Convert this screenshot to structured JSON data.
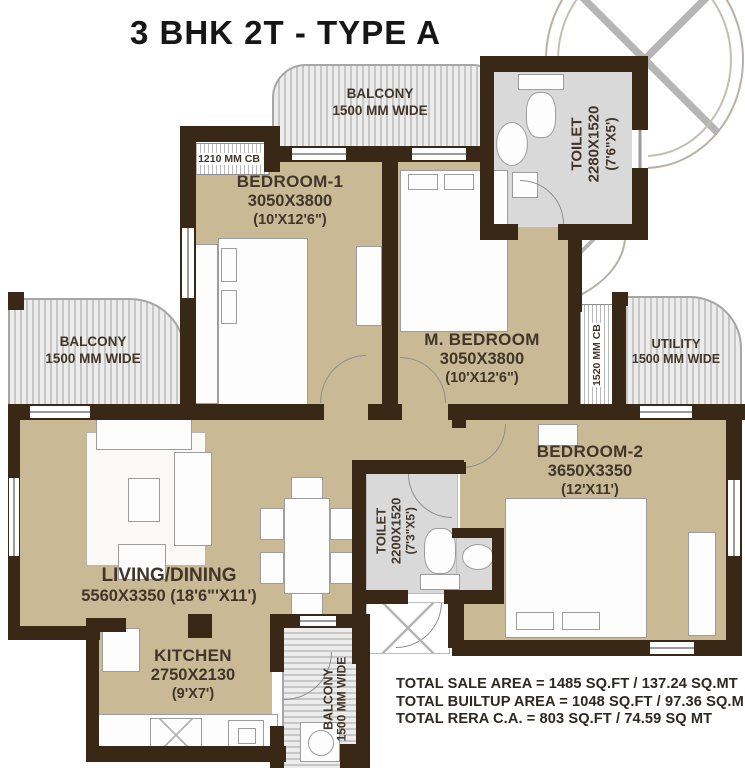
{
  "title": "3 BHK 2T - TYPE A",
  "colors": {
    "wall": "#3a2817",
    "floor": "#c9ba95",
    "balcony_fill": "#e0e0e0",
    "toilet_fill": "#d9d9d9",
    "label_text": "#42352a"
  },
  "rooms": {
    "bedroom1": {
      "name": "BEDROOM-1",
      "dim_mm": "3050X3800",
      "dim_ft": "(10'X12'6\")"
    },
    "m_bedroom": {
      "name": "M. BEDROOM",
      "dim_mm": "3050X3800",
      "dim_ft": "(10'X12'6\")"
    },
    "bedroom2": {
      "name": "BEDROOM-2",
      "dim_mm": "3650X3350",
      "dim_ft": "(12'X11')"
    },
    "living_dining": {
      "name": "LIVING/DINING",
      "dims": "5560X3350 (18'6\"'X11')"
    },
    "kitchen": {
      "name": "KITCHEN",
      "dim_mm": "2750X2130",
      "dim_ft": "(9'X7')"
    },
    "toilet_top": {
      "name": "TOILET",
      "dim_mm": "2280X1520",
      "dim_ft": "(7'6\"X5')"
    },
    "toilet_mid": {
      "name": "TOILET",
      "dim_mm": "2200X1520",
      "dim_ft": "(7'3\"X5')"
    },
    "balcony_top": {
      "name": "BALCONY",
      "width": "1500 MM WIDE"
    },
    "balcony_left": {
      "name": "BALCONY",
      "width": "1500 MM WIDE"
    },
    "balcony_bottom": {
      "name": "BALCONY",
      "width": "1500 MM WIDE"
    },
    "utility": {
      "name": "UTILITY",
      "width": "1500 MM WIDE"
    }
  },
  "cupboards": {
    "cb_bedroom1": "1210 MM CB",
    "cb_m_bedroom": "1520 MM CB"
  },
  "totals": {
    "sale": "TOTAL SALE AREA  = 1485 SQ.FT / 137.24 SQ.MT",
    "builtup": "TOTAL BUILTUP AREA = 1048 SQ.FT / 97.36 SQ.M",
    "rera": "TOTAL RERA C.A. = 803 SQ.FT / 74.59 SQ MT"
  }
}
